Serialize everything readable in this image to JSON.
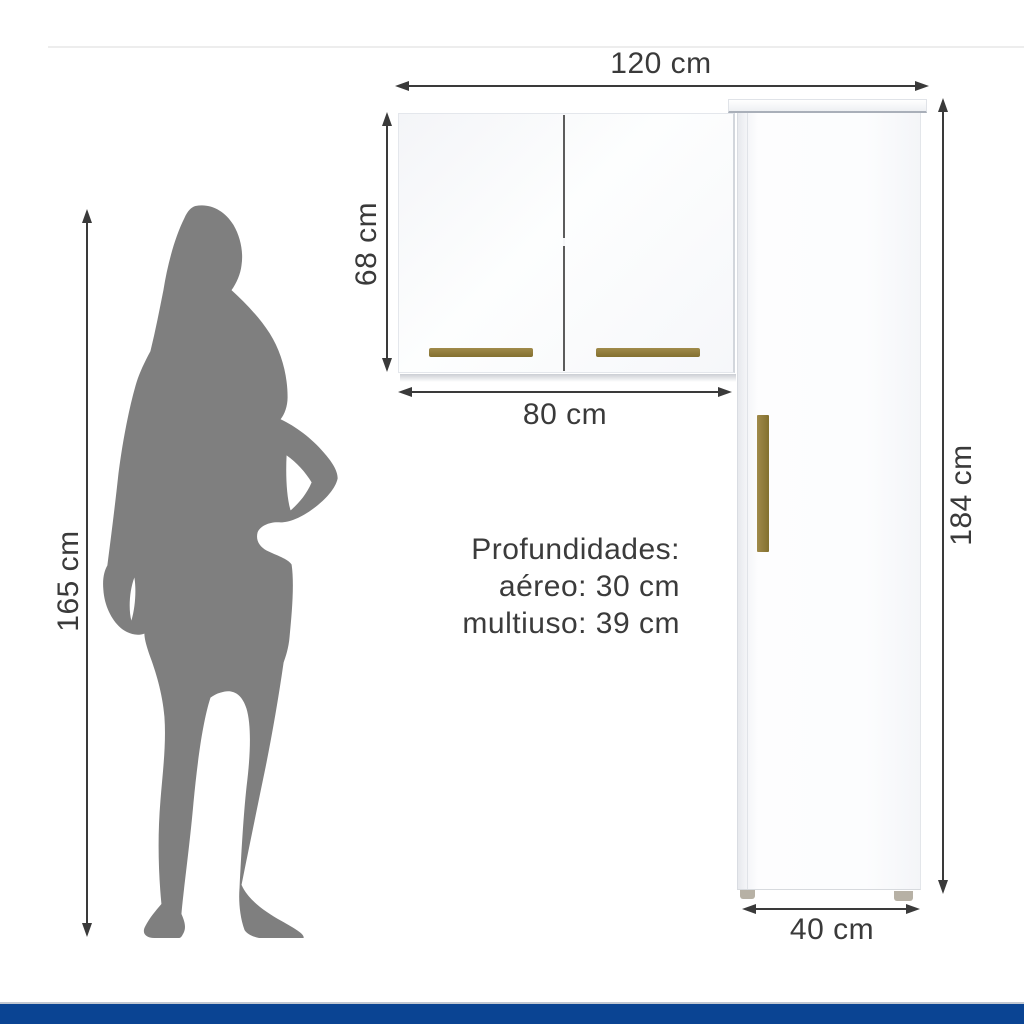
{
  "figure_type": "furniture-dimensions-diagram",
  "dimensions": {
    "total_width": "120 cm",
    "aereo_height": "68 cm",
    "aereo_width": "80 cm",
    "multiuso_height": "184 cm",
    "multiuso_width": "40 cm",
    "person_height": "165 cm"
  },
  "depths": {
    "title": "Profundidades:",
    "aereo": "aéreo: 30 cm",
    "multiuso": "multiuso: 39 cm"
  },
  "icons": {
    "person_silhouette": "woman-silhouette"
  },
  "colors": {
    "accent_bar": "#0a4493",
    "dimension_text": "#3a3a3a",
    "silhouette_gray": "#7f7f7f",
    "handle_gold": "#8c783c",
    "cabinet_white": "#fdfdfe"
  }
}
